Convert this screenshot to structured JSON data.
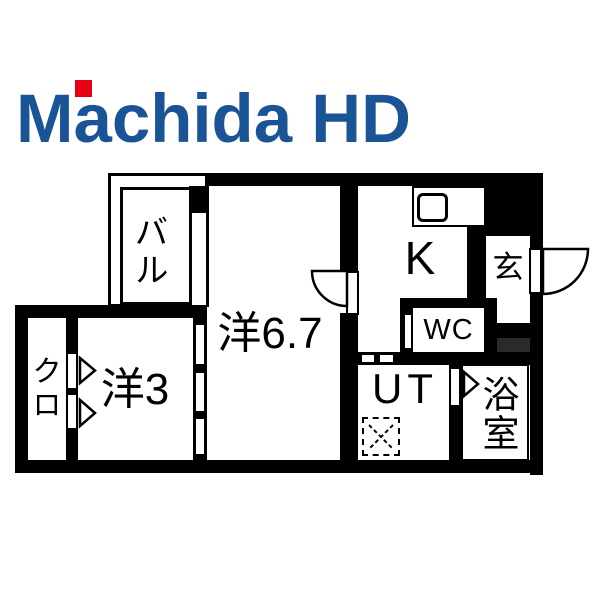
{
  "logo": {
    "text": "Machida HD",
    "text_color": "#1b5496",
    "accent_color": "#e60013"
  },
  "floorplan": {
    "background": "#ffffff",
    "wall_color": "#000000",
    "step_color": "#2a2a2a",
    "rooms": {
      "balcony": "バル",
      "main_room": "洋6.7",
      "kitchen": "K",
      "entrance": "玄",
      "toilet": "WC",
      "closet": "クロ",
      "bedroom": "洋3",
      "utility": "UT",
      "bathroom": "浴室"
    },
    "icons": {
      "sink": "kitchen-sink-icon",
      "washer": "washing-machine-space-icon",
      "door_swing": "door-swing-arc-icon",
      "door_marker": "door-triangle-icon"
    }
  }
}
